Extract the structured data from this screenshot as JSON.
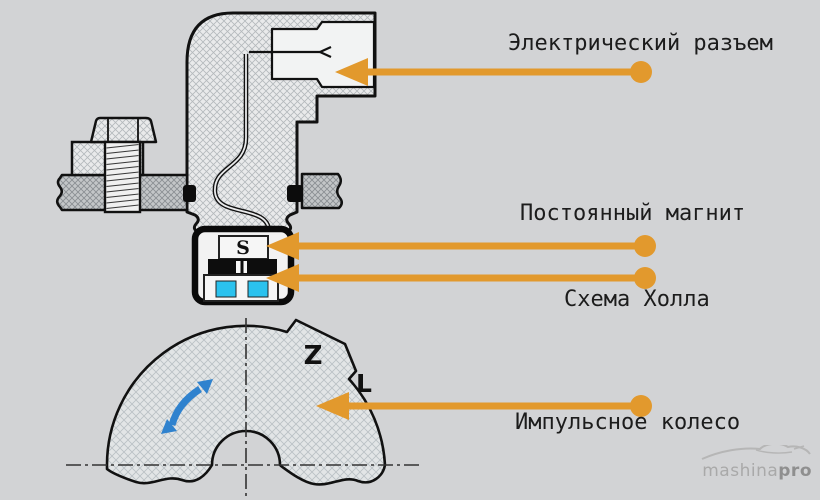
{
  "diagram_subject": "Hall-effect sensor cross-section with impulse wheel",
  "background_color": "#d2d3d5",
  "labels": {
    "connector": "Электрический разъем",
    "magnet": "Постоянный магнит",
    "hall": "Схема Холла",
    "wheel": "Импульсное колесо"
  },
  "letters": {
    "magnet_pole": "S",
    "tooth": "Z",
    "gap": "L"
  },
  "colors": {
    "callout_orange": "#E2992D",
    "hall_cyan": "#2BC2EE",
    "rotation_blue": "#2F82CE",
    "outline_black": "#111111"
  },
  "watermark": {
    "brand": "mashina",
    "brand_suffix": "pro"
  }
}
